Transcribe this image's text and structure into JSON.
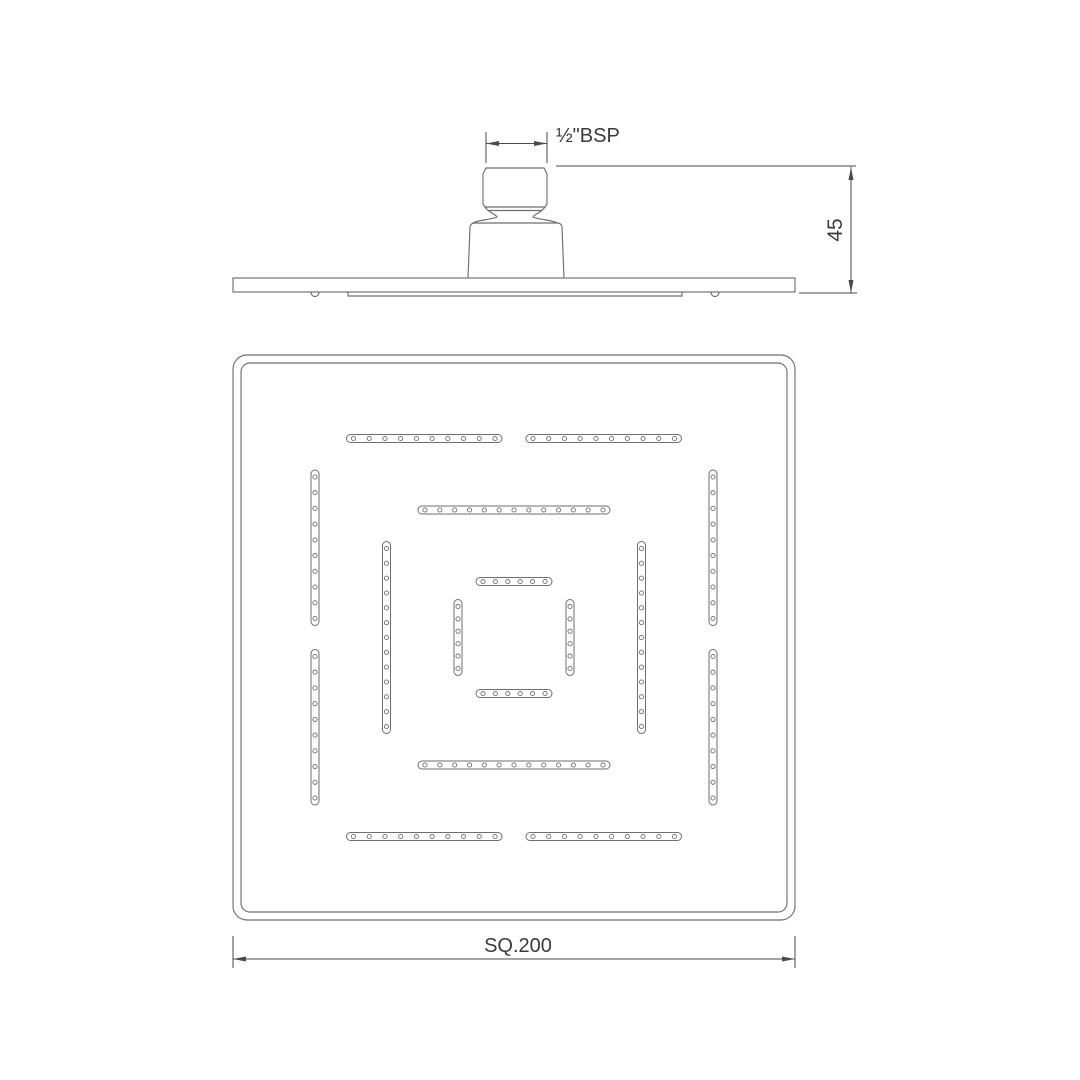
{
  "page": {
    "background": "#ffffff"
  },
  "drawing": {
    "line_color": "#6e6e6e",
    "dim_color": "#4a4a4a",
    "text_color": "#3a3a3a",
    "dimensions": {
      "thread_label": "½\"BSP",
      "height_label": "45",
      "width_label": "SQ.200"
    },
    "face_view": {
      "center": {
        "x": 514,
        "y": 637.5
      },
      "square_outer": {
        "x": 233,
        "y": 355,
        "w": 562,
        "h": 565,
        "r": 14
      },
      "square_inner": {
        "x": 241,
        "y": 363,
        "w": 546,
        "h": 549,
        "r": 9
      },
      "slot_thickness": 8,
      "hole_radius": 2.1,
      "hole_end_margin": 7,
      "rings": [
        {
          "name": "outer-ring",
          "offset": 199,
          "segments": [
            [
              -167.5,
              -12
            ],
            [
              12,
              167.5
            ]
          ],
          "holes_per_segment": 10
        },
        {
          "name": "middle-ring",
          "offset": 127.5,
          "segments": [
            [
              -96,
              96
            ]
          ],
          "holes_per_segment": 13
        },
        {
          "name": "inner-ring",
          "offset": 56,
          "segments": [
            [
              -38,
              38
            ]
          ],
          "holes_per_segment": 6
        }
      ]
    }
  }
}
